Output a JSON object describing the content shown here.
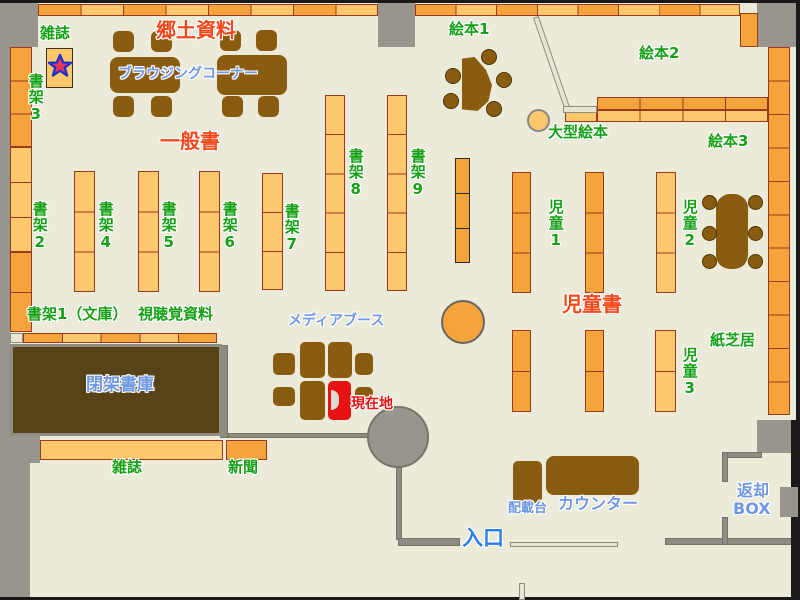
{
  "map_title": "library-floor-map",
  "colors": {
    "floor": "#ecead9",
    "wall": "#98968c",
    "shelf_light": "#fdc76c",
    "shelf_dark": "#f5a43c",
    "shelf_border": "#9c3a20",
    "furniture": "#8a5c10",
    "closed_stacks": "#584319",
    "current_location": "#e81212",
    "label_green": "#15a015",
    "label_red": "#f4491d",
    "label_blue": "#6f97e6",
    "label_entrance_blue": "#2b7de8",
    "cream": "#e8e5d2"
  },
  "labels": [
    {
      "id": "magazines-top",
      "text": "雑誌",
      "color": "green",
      "x": 40,
      "y": 26,
      "size": 15,
      "vert": false
    },
    {
      "id": "shelf-3",
      "text": "書架3",
      "color": "green",
      "x": 27,
      "y": 73,
      "size": 15,
      "vert": true
    },
    {
      "id": "shelf-2",
      "text": "書架2",
      "color": "green",
      "x": 31,
      "y": 201,
      "size": 15,
      "vert": true
    },
    {
      "id": "shelf-4",
      "text": "書架4",
      "color": "green",
      "x": 97,
      "y": 201,
      "size": 15,
      "vert": true
    },
    {
      "id": "shelf-5",
      "text": "書架5",
      "color": "green",
      "x": 160,
      "y": 201,
      "size": 15,
      "vert": true
    },
    {
      "id": "shelf-6",
      "text": "書架6",
      "color": "green",
      "x": 221,
      "y": 201,
      "size": 15,
      "vert": true
    },
    {
      "id": "shelf-7",
      "text": "書架7",
      "color": "green",
      "x": 283,
      "y": 203,
      "size": 15,
      "vert": true
    },
    {
      "id": "shelf-8",
      "text": "書架8",
      "color": "green",
      "x": 347,
      "y": 148,
      "size": 15,
      "vert": true
    },
    {
      "id": "shelf-9",
      "text": "書架9",
      "color": "green",
      "x": 409,
      "y": 148,
      "size": 15,
      "vert": true
    },
    {
      "id": "picture-books-1",
      "text": "絵本1",
      "color": "green",
      "x": 449,
      "y": 22,
      "size": 15,
      "vert": false
    },
    {
      "id": "picture-books-2",
      "text": "絵本2",
      "color": "green",
      "x": 639,
      "y": 46,
      "size": 15,
      "vert": false
    },
    {
      "id": "picture-books-3",
      "text": "絵本3",
      "color": "green",
      "x": 708,
      "y": 134,
      "size": 15,
      "vert": false
    },
    {
      "id": "large-picture-books",
      "text": "大型絵本",
      "color": "green",
      "x": 548,
      "y": 125,
      "size": 15,
      "vert": false
    },
    {
      "id": "children-1",
      "text": "児童1",
      "color": "green",
      "x": 547,
      "y": 199,
      "size": 15,
      "vert": true
    },
    {
      "id": "children-2",
      "text": "児童2",
      "color": "green",
      "x": 681,
      "y": 199,
      "size": 15,
      "vert": true
    },
    {
      "id": "children-3",
      "text": "児童3",
      "color": "green",
      "x": 681,
      "y": 347,
      "size": 15,
      "vert": true
    },
    {
      "id": "kamishibai",
      "text": "紙芝居",
      "color": "green",
      "x": 710,
      "y": 333,
      "size": 15,
      "vert": false
    },
    {
      "id": "shelf-1-bunko",
      "text": "書架1（文庫）",
      "color": "green",
      "x": 27,
      "y": 307,
      "size": 15,
      "vert": false
    },
    {
      "id": "audiovisual",
      "text": "視聴覚資料",
      "color": "green",
      "x": 138,
      "y": 307,
      "size": 15,
      "vert": false
    },
    {
      "id": "magazines-bottom",
      "text": "雑誌",
      "color": "green",
      "x": 112,
      "y": 460,
      "size": 15,
      "vert": false
    },
    {
      "id": "newspapers",
      "text": "新聞",
      "color": "green",
      "x": 228,
      "y": 460,
      "size": 15,
      "vert": false
    },
    {
      "id": "local-materials",
      "text": "郷土資料",
      "color": "red",
      "x": 156,
      "y": 20,
      "size": 20,
      "vert": false
    },
    {
      "id": "general-books",
      "text": "一般書",
      "color": "red",
      "x": 160,
      "y": 131,
      "size": 20,
      "vert": false
    },
    {
      "id": "children-books",
      "text": "児童書",
      "color": "red",
      "x": 562,
      "y": 294,
      "size": 20,
      "vert": false
    },
    {
      "id": "browsing-corner",
      "text": "ブラウジングコーナー",
      "color": "blue",
      "x": 118,
      "y": 67,
      "size": 14,
      "vert": false
    },
    {
      "id": "media-booth",
      "text": "メディアブース",
      "color": "blue",
      "x": 288,
      "y": 314,
      "size": 14,
      "vert": false
    },
    {
      "id": "closed-stacks",
      "text": "閉架書庫",
      "color": "blue",
      "x": 86,
      "y": 377,
      "size": 17,
      "vert": false
    },
    {
      "id": "counter",
      "text": "カウンター",
      "color": "blue",
      "x": 558,
      "y": 496,
      "size": 16,
      "vert": false
    },
    {
      "id": "loading-desk",
      "text": "配載台",
      "color": "blue",
      "x": 508,
      "y": 502,
      "size": 13,
      "vert": false
    },
    {
      "id": "return-box-1",
      "text": "返却",
      "color": "blue",
      "x": 737,
      "y": 483,
      "size": 16,
      "vert": false
    },
    {
      "id": "return-box-2",
      "text": "BOX",
      "color": "blue",
      "x": 733,
      "y": 501,
      "size": 16,
      "vert": false
    },
    {
      "id": "current-location",
      "text": "現在地",
      "color": "red2",
      "x": 351,
      "y": 397,
      "size": 14,
      "vert": false
    },
    {
      "id": "entrance",
      "text": "入口",
      "color": "blue2",
      "x": 462,
      "y": 527,
      "size": 21,
      "vert": false
    }
  ],
  "walls": [
    {
      "x": 0,
      "y": 0,
      "w": 38,
      "h": 47,
      "tone": "wall"
    },
    {
      "x": 0,
      "y": 3,
      "w": 10,
      "h": 594,
      "tone": "wall"
    },
    {
      "x": 378,
      "y": 3,
      "w": 37,
      "h": 44,
      "tone": "wall"
    },
    {
      "x": 757,
      "y": 3,
      "w": 39,
      "h": 44,
      "tone": "wall"
    },
    {
      "x": 0,
      "y": 413,
      "w": 40,
      "h": 50,
      "tone": "wall"
    },
    {
      "x": 0,
      "y": 430,
      "w": 30,
      "h": 167,
      "tone": "wall"
    },
    {
      "x": 757,
      "y": 420,
      "w": 39,
      "h": 33,
      "tone": "wall"
    },
    {
      "x": 220,
      "y": 345,
      "w": 8,
      "h": 93,
      "tone": "thin"
    },
    {
      "x": 228,
      "y": 433,
      "w": 140,
      "h": 5,
      "tone": "thin"
    },
    {
      "x": 396,
      "y": 465,
      "w": 6,
      "h": 75,
      "tone": "thin"
    },
    {
      "x": 398,
      "y": 538,
      "w": 62,
      "h": 8,
      "tone": "thin"
    },
    {
      "x": 665,
      "y": 538,
      "w": 131,
      "h": 7,
      "tone": "thin"
    },
    {
      "x": 722,
      "y": 452,
      "w": 40,
      "h": 6,
      "tone": "thin"
    },
    {
      "x": 722,
      "y": 452,
      "w": 6,
      "h": 30,
      "tone": "thin"
    },
    {
      "x": 722,
      "y": 517,
      "w": 6,
      "h": 28,
      "tone": "thin"
    },
    {
      "x": 0,
      "y": 0,
      "w": 800,
      "h": 3,
      "tone": "black"
    },
    {
      "x": 796,
      "y": 0,
      "w": 4,
      "h": 600,
      "tone": "black"
    },
    {
      "x": 0,
      "y": 597,
      "w": 800,
      "h": 3,
      "tone": "black"
    },
    {
      "x": 791,
      "y": 420,
      "w": 5,
      "h": 177,
      "tone": "black"
    },
    {
      "x": 780,
      "y": 487,
      "w": 18,
      "h": 30,
      "tone": "wall"
    }
  ],
  "shelves": [
    {
      "name": "top-row-left",
      "x": 38,
      "y": 4,
      "w": 340,
      "h": 12,
      "dir": "h",
      "seg": 8,
      "tone": "A"
    },
    {
      "name": "top-row-right",
      "x": 415,
      "y": 4,
      "w": 325,
      "h": 12,
      "dir": "h",
      "seg": 8,
      "tone": "A"
    },
    {
      "name": "top-right-corner",
      "x": 740,
      "y": 13,
      "w": 18,
      "h": 34,
      "dir": "v",
      "seg": 1,
      "tone": "D"
    },
    {
      "name": "right-wall-shelf",
      "x": 768,
      "y": 47,
      "w": 22,
      "h": 368,
      "dir": "v",
      "seg": 11,
      "tone": "D"
    },
    {
      "name": "left-wall-shelf-a",
      "x": 10,
      "y": 47,
      "w": 22,
      "h": 100,
      "dir": "v",
      "seg": 3,
      "tone": "D"
    },
    {
      "name": "left-wall-shelf-b",
      "x": 10,
      "y": 147,
      "w": 22,
      "h": 105,
      "dir": "v",
      "seg": 3,
      "tone": "L"
    },
    {
      "name": "left-wall-shelf-c",
      "x": 10,
      "y": 252,
      "w": 22,
      "h": 80,
      "dir": "v",
      "seg": 2,
      "tone": "D"
    },
    {
      "name": "shelf4-col",
      "x": 74,
      "y": 171,
      "w": 21,
      "h": 121,
      "dir": "v",
      "seg": 3,
      "tone": "L"
    },
    {
      "name": "shelf5-col",
      "x": 138,
      "y": 171,
      "w": 21,
      "h": 121,
      "dir": "v",
      "seg": 3,
      "tone": "L"
    },
    {
      "name": "shelf6-col",
      "x": 199,
      "y": 171,
      "w": 21,
      "h": 121,
      "dir": "v",
      "seg": 3,
      "tone": "L"
    },
    {
      "name": "shelf7-col",
      "x": 262,
      "y": 173,
      "w": 21,
      "h": 117,
      "dir": "v",
      "seg": 3,
      "tone": "L"
    },
    {
      "name": "shelf8-col",
      "x": 325,
      "y": 95,
      "w": 20,
      "h": 196,
      "dir": "v",
      "seg": 5,
      "tone": "L"
    },
    {
      "name": "shelf9-col",
      "x": 387,
      "y": 95,
      "w": 20,
      "h": 196,
      "dir": "v",
      "seg": 5,
      "tone": "L"
    },
    {
      "name": "av-col",
      "x": 455,
      "y": 158,
      "w": 15,
      "h": 105,
      "dir": "v",
      "seg": 3,
      "tone": "D",
      "border": "bblack"
    },
    {
      "name": "children1-col-upper",
      "x": 512,
      "y": 172,
      "w": 19,
      "h": 121,
      "dir": "v",
      "seg": 3,
      "tone": "D"
    },
    {
      "name": "children2-col-upper",
      "x": 585,
      "y": 172,
      "w": 19,
      "h": 121,
      "dir": "v",
      "seg": 3,
      "tone": "D"
    },
    {
      "name": "children-col-light-upper",
      "x": 656,
      "y": 172,
      "w": 20,
      "h": 121,
      "dir": "v",
      "seg": 3,
      "tone": "L"
    },
    {
      "name": "children1-col-lower",
      "x": 512,
      "y": 330,
      "w": 19,
      "h": 82,
      "dir": "v",
      "seg": 2,
      "tone": "D"
    },
    {
      "name": "children2-col-lower",
      "x": 585,
      "y": 330,
      "w": 19,
      "h": 82,
      "dir": "v",
      "seg": 2,
      "tone": "D"
    },
    {
      "name": "children3-col-lower",
      "x": 655,
      "y": 330,
      "w": 21,
      "h": 82,
      "dir": "v",
      "seg": 2,
      "tone": "L"
    },
    {
      "name": "ehon-row-top",
      "x": 597,
      "y": 97,
      "w": 171,
      "h": 13,
      "dir": "h",
      "seg": 4,
      "tone": "D"
    },
    {
      "name": "ehon-row-bottom",
      "x": 597,
      "y": 110,
      "w": 171,
      "h": 12,
      "dir": "h",
      "seg": 4,
      "tone": "L"
    },
    {
      "name": "ehon-row-single",
      "x": 565,
      "y": 110,
      "w": 32,
      "h": 12,
      "dir": "h",
      "seg": 1,
      "tone": "L"
    },
    {
      "name": "av-row-cream",
      "x": 10,
      "y": 333,
      "w": 13,
      "h": 10,
      "dir": "h",
      "seg": 1,
      "tone": "C"
    },
    {
      "name": "av-row",
      "x": 23,
      "y": 333,
      "w": 194,
      "h": 10,
      "dir": "h",
      "seg": 5,
      "tone": "A"
    },
    {
      "name": "magazine-rack",
      "x": 40,
      "y": 440,
      "w": 183,
      "h": 20,
      "dir": "h",
      "seg": 1,
      "tone": "L"
    },
    {
      "name": "newspaper-rack",
      "x": 226,
      "y": 440,
      "w": 41,
      "h": 20,
      "dir": "h",
      "seg": 1,
      "tone": "D"
    },
    {
      "name": "magazine-display",
      "x": 46,
      "y": 48,
      "w": 27,
      "h": 40,
      "dir": "v",
      "seg": 1,
      "tone": "L",
      "border": "bdark"
    }
  ],
  "furniture": [
    {
      "name": "browsing-table",
      "type": "rect",
      "x": 110,
      "y": 57,
      "w": 70,
      "h": 36,
      "r": 8
    },
    {
      "name": "browsing-table",
      "type": "rect",
      "x": 217,
      "y": 55,
      "w": 70,
      "h": 40,
      "r": 8
    },
    {
      "name": "chair",
      "type": "rect",
      "x": 113,
      "y": 31,
      "w": 21,
      "h": 21,
      "r": 6
    },
    {
      "name": "chair",
      "type": "rect",
      "x": 151,
      "y": 31,
      "w": 21,
      "h": 21,
      "r": 6
    },
    {
      "name": "chair",
      "type": "rect",
      "x": 220,
      "y": 30,
      "w": 21,
      "h": 21,
      "r": 6
    },
    {
      "name": "chair",
      "type": "rect",
      "x": 256,
      "y": 30,
      "w": 21,
      "h": 21,
      "r": 6
    },
    {
      "name": "chair",
      "type": "rect",
      "x": 113,
      "y": 96,
      "w": 21,
      "h": 21,
      "r": 6
    },
    {
      "name": "chair",
      "type": "rect",
      "x": 151,
      "y": 96,
      "w": 21,
      "h": 21,
      "r": 6
    },
    {
      "name": "chair",
      "type": "rect",
      "x": 222,
      "y": 96,
      "w": 21,
      "h": 21,
      "r": 6
    },
    {
      "name": "chair",
      "type": "rect",
      "x": 258,
      "y": 96,
      "w": 21,
      "h": 21,
      "r": 6
    },
    {
      "name": "children-table",
      "type": "rect",
      "x": 716,
      "y": 194,
      "w": 32,
      "h": 75,
      "r": 14
    },
    {
      "name": "counter-desk",
      "type": "rect",
      "x": 546,
      "y": 456,
      "w": 93,
      "h": 39,
      "r": 8
    },
    {
      "name": "loading-desk",
      "type": "rect",
      "x": 513,
      "y": 461,
      "w": 29,
      "h": 42,
      "r": 5
    },
    {
      "name": "media-booth-seat",
      "type": "rect",
      "x": 300,
      "y": 342,
      "w": 25,
      "h": 36,
      "r": 5
    },
    {
      "name": "media-booth-seat",
      "type": "rect",
      "x": 328,
      "y": 342,
      "w": 24,
      "h": 36,
      "r": 5
    },
    {
      "name": "media-booth-seat",
      "type": "rect",
      "x": 300,
      "y": 381,
      "w": 25,
      "h": 39,
      "r": 5
    },
    {
      "name": "media-booth-seat",
      "type": "rect",
      "x": 273,
      "y": 353,
      "w": 22,
      "h": 22,
      "r": 5
    },
    {
      "name": "media-booth-seat",
      "type": "rect",
      "x": 273,
      "y": 387,
      "w": 22,
      "h": 19,
      "r": 5
    },
    {
      "name": "media-booth-seat",
      "type": "rect",
      "x": 355,
      "y": 353,
      "w": 18,
      "h": 22,
      "r": 5
    },
    {
      "name": "media-booth-seat",
      "type": "rect",
      "x": 355,
      "y": 387,
      "w": 18,
      "h": 20,
      "r": 5
    },
    {
      "name": "current-location-booth",
      "type": "redbooth",
      "x": 328,
      "y": 381,
      "w": 23,
      "h": 39
    },
    {
      "name": "reading-fan-table",
      "type": "fan",
      "x": 462,
      "y": 57,
      "w": 30,
      "h": 54
    },
    {
      "name": "stool",
      "type": "circle",
      "x": 481,
      "y": 49,
      "d": 16
    },
    {
      "name": "stool",
      "type": "circle",
      "x": 445,
      "y": 68,
      "d": 16
    },
    {
      "name": "stool",
      "type": "circle",
      "x": 443,
      "y": 93,
      "d": 16
    },
    {
      "name": "stool",
      "type": "circle",
      "x": 496,
      "y": 72,
      "d": 16
    },
    {
      "name": "stool",
      "type": "circle",
      "x": 486,
      "y": 101,
      "d": 16
    },
    {
      "name": "stool",
      "type": "circle",
      "x": 702,
      "y": 195,
      "d": 15
    },
    {
      "name": "stool",
      "type": "circle",
      "x": 748,
      "y": 195,
      "d": 15
    },
    {
      "name": "stool",
      "type": "circle",
      "x": 702,
      "y": 226,
      "d": 15
    },
    {
      "name": "stool",
      "type": "circle",
      "x": 748,
      "y": 226,
      "d": 15
    },
    {
      "name": "stool",
      "type": "circle",
      "x": 702,
      "y": 254,
      "d": 15
    },
    {
      "name": "stool",
      "type": "circle",
      "x": 748,
      "y": 254,
      "d": 15
    }
  ],
  "round_features": [
    {
      "name": "round-table",
      "x": 441,
      "y": 300,
      "d": 44,
      "fill": "#f5a43c",
      "border": "#666"
    },
    {
      "name": "large-picture-book-bin",
      "x": 527,
      "y": 109,
      "d": 23,
      "fill": "#fdc76c",
      "border": "#888"
    },
    {
      "name": "round-pillar",
      "x": 367,
      "y": 406,
      "d": 62,
      "fill": "#98968c",
      "border": "#77756b"
    }
  ],
  "deco": [
    {
      "name": "diagonal-divider",
      "x": 533,
      "y": 18,
      "w": 6,
      "h": 96,
      "rot": -19
    },
    {
      "name": "divider-foot",
      "x": 563,
      "y": 106,
      "w": 34,
      "h": 7,
      "rot": 0
    },
    {
      "name": "entrance-mat",
      "x": 510,
      "y": 542,
      "w": 108,
      "h": 5,
      "rot": 0
    },
    {
      "name": "door-post",
      "x": 519,
      "y": 583,
      "w": 6,
      "h": 17,
      "rot": 0
    }
  ]
}
